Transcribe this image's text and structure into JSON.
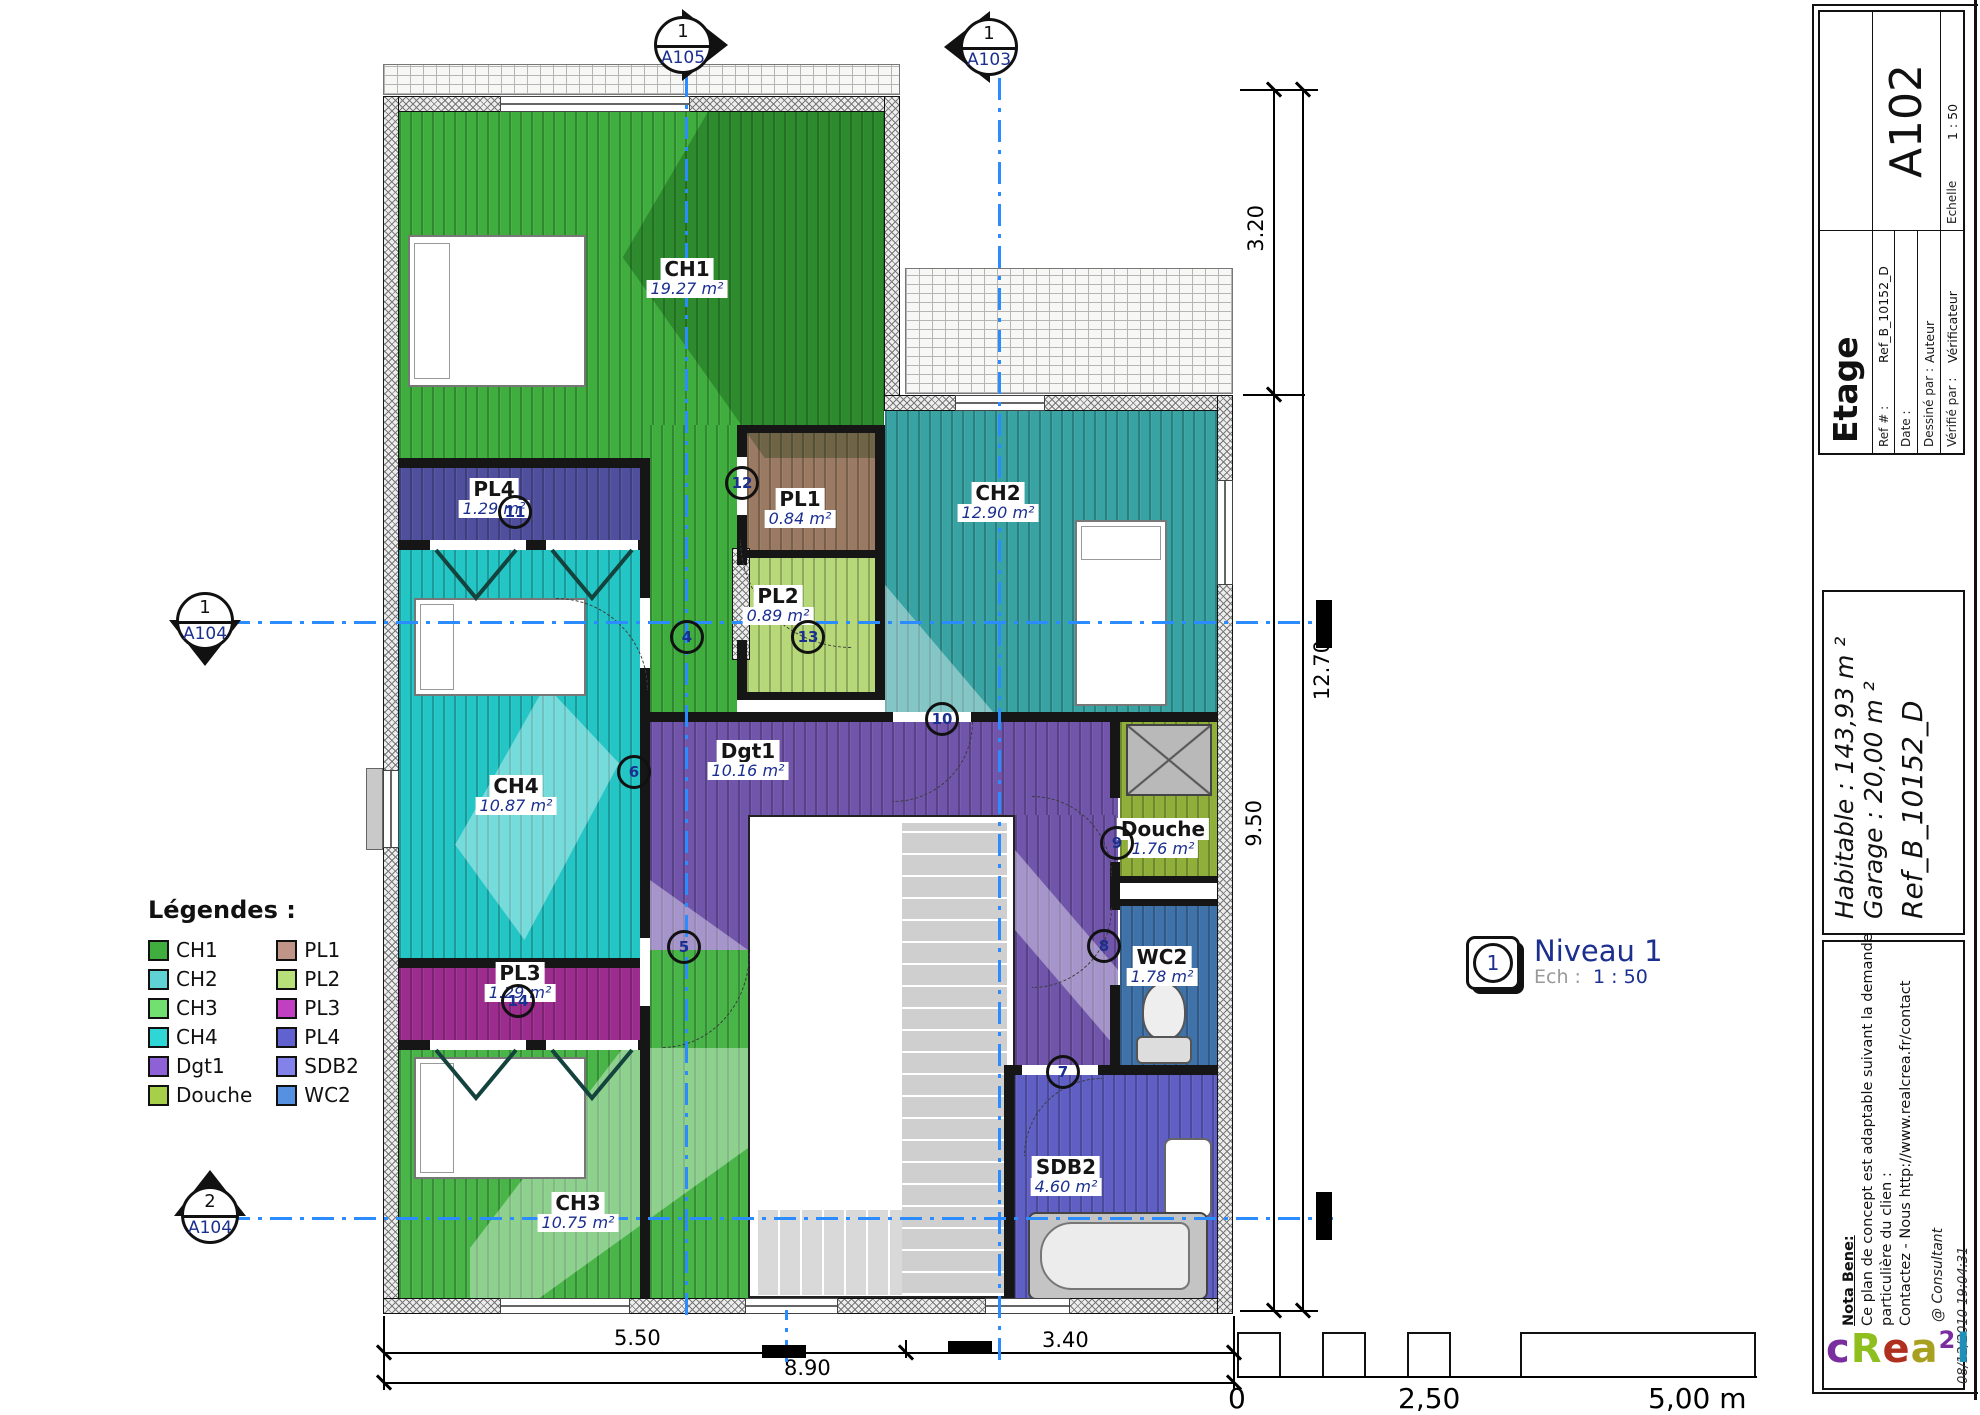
{
  "sheet": {
    "code": "A102",
    "view_title": "Etage",
    "scale": "1 : 50",
    "fields": {
      "ref_label": "Ref # :",
      "ref_value": "Ref_B_10152_D",
      "date_label": "Date :",
      "date_value": "",
      "drawn_label": "Dessiné par :",
      "drawn_value": "Auteur",
      "checked_label": "Vérifié par :",
      "checked_value": "Vérificateur",
      "scale_label": "Echelle"
    },
    "areas": {
      "habitable": "Habitable : 143,93 m ²",
      "garage": "Garage : 20,00 m ²",
      "ref": "Ref_B_10152_D"
    },
    "nota": {
      "title": "Nota Bene:",
      "lines": [
        "Ce plan de concept est adaptable suivant la demande",
        "particulière du clien :",
        "Contactez - Nous http://www.realcrea.fr/contact"
      ]
    },
    "consultant": "@ Consultant",
    "datetime": "08/12/2010 19:04:31",
    "logo_letters": [
      {
        "ch": "c",
        "color": "#7a2d9e",
        "sup": false
      },
      {
        "ch": "R",
        "color": "#8fbf1f",
        "sup": false
      },
      {
        "ch": "e",
        "color": "#b03020",
        "sup": false
      },
      {
        "ch": "a",
        "color": "#a8a020",
        "sup": false
      },
      {
        "ch": "2",
        "color": "#7a2d9e",
        "sup": true
      },
      {
        "ch": "l",
        "color": "#2090b8",
        "sup": false
      }
    ]
  },
  "view_label": {
    "number": "1",
    "name": "Niveau 1",
    "scale_prefix": "Ech :",
    "scale": "1 : 50"
  },
  "legend": {
    "title": "Légendes :",
    "items": [
      {
        "label": "CH1",
        "color": "#3fae3f"
      },
      {
        "label": "CH2",
        "color": "#5fd3d3"
      },
      {
        "label": "CH3",
        "color": "#71e071"
      },
      {
        "label": "CH4",
        "color": "#2fd6d6"
      },
      {
        "label": "Dgt1",
        "color": "#8e62d6"
      },
      {
        "label": "Douche",
        "color": "#a7cf4a"
      },
      {
        "label": "PL1",
        "color": "#c09486"
      },
      {
        "label": "PL2",
        "color": "#b8e07a"
      },
      {
        "label": "PL3",
        "color": "#c13fc1"
      },
      {
        "label": "PL4",
        "color": "#6161cf"
      },
      {
        "label": "SDB2",
        "color": "#8282ea"
      },
      {
        "label": "WC2",
        "color": "#5591e0"
      }
    ]
  },
  "rooms": {
    "ch1": {
      "name": "CH1",
      "area": "19.27 m²"
    },
    "ch2": {
      "name": "CH2",
      "area": "12.90 m²"
    },
    "ch3": {
      "name": "CH3",
      "area": "10.75 m²"
    },
    "ch4": {
      "name": "CH4",
      "area": "10.87 m²"
    },
    "pl1": {
      "name": "PL1",
      "area": "0.84 m²"
    },
    "pl2": {
      "name": "PL2",
      "area": "0.89 m²"
    },
    "pl3": {
      "name": "PL3",
      "area": "1.29 m²"
    },
    "pl4": {
      "name": "PL4",
      "area": "1.29 m²"
    },
    "dgt1": {
      "name": "Dgt1",
      "area": "10.16 m²"
    },
    "douche": {
      "name": "Douche",
      "area": "1.76 m²"
    },
    "wc2": {
      "name": "WC2",
      "area": "1.78 m²"
    },
    "sdb2": {
      "name": "SDB2",
      "area": "4.60 m²"
    }
  },
  "markers": {
    "m4": "4",
    "m5": "5",
    "m6": "6",
    "m7": "7",
    "m8": "8",
    "m9": "9",
    "m10": "10",
    "m11": "11",
    "m12": "12",
    "m13": "13",
    "m14": "14"
  },
  "section_markers": {
    "a105": {
      "num": "1",
      "code": "A105"
    },
    "a103": {
      "num": "1",
      "code": "A103"
    },
    "a104_1": {
      "num": "1",
      "code": "A104"
    },
    "a104_2": {
      "num": "2",
      "code": "A104"
    }
  },
  "dimensions": {
    "right": {
      "d1": "3.20",
      "d2": "12.70",
      "d3": "9.50"
    },
    "bottom": {
      "d1": "5.50",
      "d2": "3.40",
      "d3": "8.90"
    },
    "scalebar": {
      "t0": "0",
      "t1": "2,50",
      "t2": "5,00 m"
    }
  },
  "colors": {
    "axis": "#2b8cff"
  }
}
